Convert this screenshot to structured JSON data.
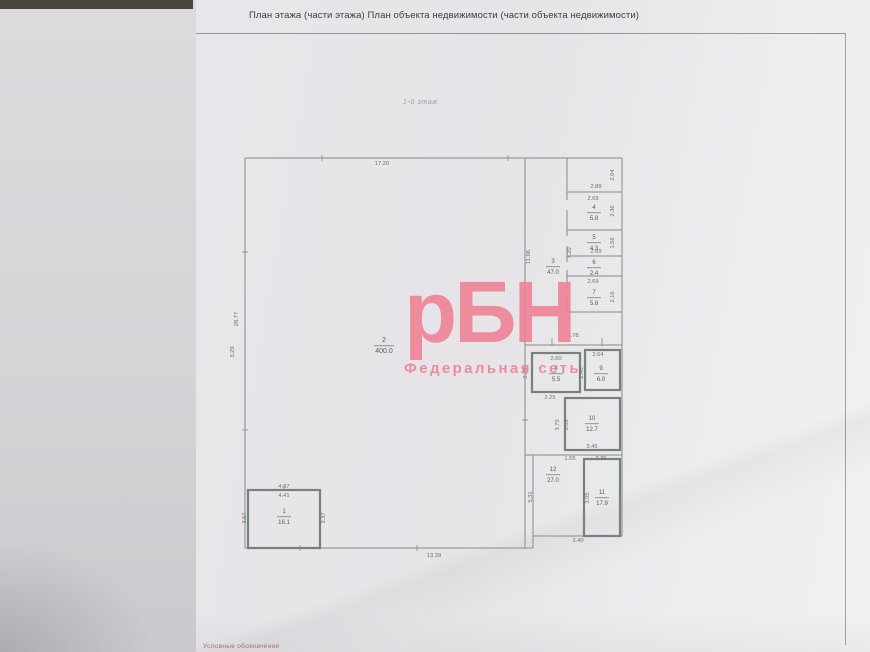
{
  "page": {
    "title": "План этажа (части этажа) План объекта недвижимости (части объекта недвижимости)",
    "floor_label": "1-й этаж",
    "legend_note": "Условные обозначения"
  },
  "watermark": {
    "logo": "рБН",
    "subtitle": "Федеральная сеть",
    "color": "#ef8093"
  },
  "plan": {
    "wall_color": "#828c85",
    "box_color": "#76827b",
    "dim_color": "#68756f",
    "label_color": "#515e58",
    "walls": [
      [
        245,
        158,
        622,
        158
      ],
      [
        245,
        158,
        245,
        548
      ],
      [
        245,
        548,
        533,
        548
      ],
      [
        533,
        548,
        533,
        536
      ],
      [
        533,
        536,
        622,
        536
      ],
      [
        622,
        158,
        622,
        536
      ],
      [
        525,
        158,
        525,
        548
      ],
      [
        533,
        455,
        533,
        536
      ],
      [
        567,
        158,
        567,
        200
      ],
      [
        567,
        210,
        567,
        236
      ],
      [
        567,
        246,
        567,
        262
      ],
      [
        567,
        270,
        567,
        288
      ],
      [
        567,
        296,
        567,
        312
      ],
      [
        567,
        192,
        622,
        192
      ],
      [
        567,
        230,
        622,
        230
      ],
      [
        567,
        256,
        622,
        256
      ],
      [
        567,
        276,
        622,
        276
      ],
      [
        567,
        312,
        622,
        312
      ],
      [
        525,
        345,
        622,
        345
      ],
      [
        525,
        455,
        622,
        455
      ]
    ],
    "boxes": [
      [
        532,
        353,
        48,
        39
      ],
      [
        585,
        350,
        35,
        40
      ],
      [
        565,
        398,
        55,
        52
      ],
      [
        584,
        459,
        36,
        77
      ],
      [
        248,
        490,
        72,
        58
      ]
    ],
    "ticks": [
      [
        322,
        155,
        322,
        161
      ],
      [
        508,
        155,
        508,
        161
      ],
      [
        242,
        252,
        248,
        252
      ],
      [
        242,
        430,
        248,
        430
      ],
      [
        300,
        545,
        300,
        551
      ],
      [
        417,
        545,
        417,
        551
      ],
      [
        552,
        338,
        552,
        346
      ],
      [
        602,
        338,
        602,
        346
      ],
      [
        284,
        485,
        284,
        491
      ],
      [
        522,
        420,
        528,
        420
      ]
    ],
    "dims": [
      {
        "t": "17.20",
        "x": 382,
        "y": 165,
        "r": 0
      },
      {
        "t": "2.89",
        "x": 596,
        "y": 188,
        "r": 0
      },
      {
        "t": "2.04",
        "x": 614,
        "y": 175,
        "r": -90
      },
      {
        "t": "2.69",
        "x": 593,
        "y": 200,
        "r": 0
      },
      {
        "t": "2.36",
        "x": 614,
        "y": 211,
        "r": -90
      },
      {
        "t": "7.20",
        "x": 571,
        "y": 253,
        "r": -90
      },
      {
        "t": "1.58",
        "x": 614,
        "y": 243,
        "r": -90
      },
      {
        "t": "2.69",
        "x": 596,
        "y": 253,
        "r": 0
      },
      {
        "t": "2.69",
        "x": 593,
        "y": 283,
        "r": 0
      },
      {
        "t": "2.16",
        "x": 614,
        "y": 297,
        "r": -90
      },
      {
        "t": "11.06",
        "x": 530,
        "y": 257,
        "r": -90
      },
      {
        "t": "5.78",
        "x": 573,
        "y": 337,
        "r": 0
      },
      {
        "t": "2.60",
        "x": 556,
        "y": 360,
        "r": 0
      },
      {
        "t": "2.64",
        "x": 598,
        "y": 356,
        "r": 0
      },
      {
        "t": "2.29",
        "x": 527,
        "y": 373,
        "r": -90
      },
      {
        "t": "2.48",
        "x": 583,
        "y": 373,
        "r": -90
      },
      {
        "t": "2.25",
        "x": 550,
        "y": 399,
        "r": 0
      },
      {
        "t": "3.70",
        "x": 559,
        "y": 425,
        "r": -90
      },
      {
        "t": "3.59",
        "x": 568,
        "y": 425,
        "r": -90
      },
      {
        "t": "3.46",
        "x": 592,
        "y": 448,
        "r": 0
      },
      {
        "t": "1.65",
        "x": 570,
        "y": 460,
        "r": 0
      },
      {
        "t": "2.35",
        "x": 601,
        "y": 460,
        "r": 0
      },
      {
        "t": "5.31",
        "x": 532,
        "y": 497,
        "r": -90
      },
      {
        "t": "3.05",
        "x": 589,
        "y": 498,
        "r": -90
      },
      {
        "t": "3.40",
        "x": 578,
        "y": 542,
        "r": 0
      },
      {
        "t": "13.39",
        "x": 434,
        "y": 557,
        "r": 0
      },
      {
        "t": "28.77",
        "x": 238,
        "y": 319,
        "r": -90
      },
      {
        "t": "3.29",
        "x": 234,
        "y": 352,
        "r": -90
      },
      {
        "t": "4.87",
        "x": 284,
        "y": 488,
        "r": 0
      },
      {
        "t": "4.41",
        "x": 284,
        "y": 497,
        "r": 0
      },
      {
        "t": "3.67",
        "x": 246,
        "y": 518,
        "r": -90
      },
      {
        "t": "3.37",
        "x": 325,
        "y": 518,
        "r": -90
      }
    ],
    "rooms": [
      {
        "n": "1",
        "a": "16.1",
        "x": 284,
        "y": 516,
        "big": false
      },
      {
        "n": "2",
        "a": "400.0",
        "x": 384,
        "y": 345,
        "big": true
      },
      {
        "n": "3",
        "a": "47.0",
        "x": 553,
        "y": 266,
        "big": false
      },
      {
        "n": "4",
        "a": "5.8",
        "x": 594,
        "y": 212,
        "big": false
      },
      {
        "n": "5",
        "a": "4.3",
        "x": 594,
        "y": 242,
        "big": false
      },
      {
        "n": "6",
        "a": "2.4",
        "x": 594,
        "y": 267,
        "big": false
      },
      {
        "n": "7",
        "a": "5.8",
        "x": 594,
        "y": 297,
        "big": false
      },
      {
        "n": "8",
        "a": "5.5",
        "x": 556,
        "y": 373,
        "big": false
      },
      {
        "n": "9",
        "a": "6.0",
        "x": 601,
        "y": 373,
        "big": false
      },
      {
        "n": "10",
        "a": "12.7",
        "x": 592,
        "y": 423,
        "big": false
      },
      {
        "n": "11",
        "a": "17.9",
        "x": 602,
        "y": 497,
        "big": false
      },
      {
        "n": "12",
        "a": "27.0",
        "x": 553,
        "y": 474,
        "big": false
      }
    ]
  }
}
